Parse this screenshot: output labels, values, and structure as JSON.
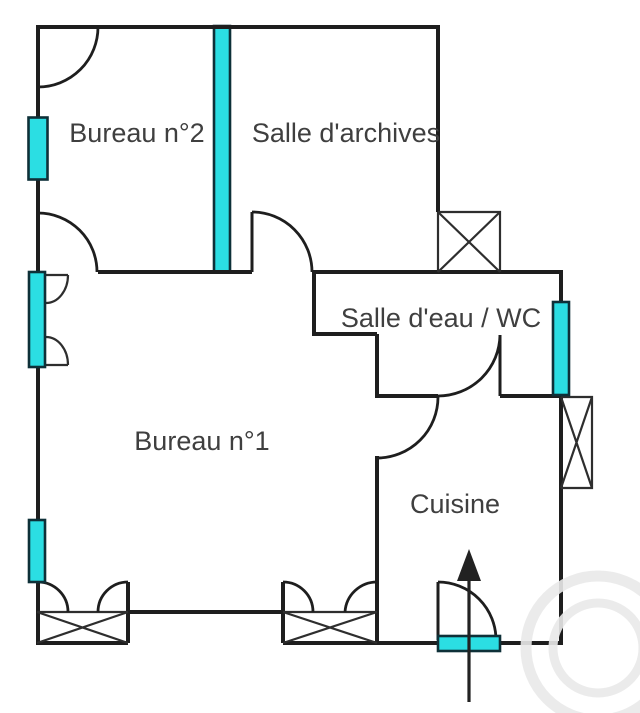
{
  "figure": {
    "type": "floor-plan"
  },
  "rooms": [
    {
      "id": "bureau-2",
      "label": "Bureau n°2"
    },
    {
      "id": "salle-archives",
      "label": "Salle d'archives"
    },
    {
      "id": "salle-eau-wc",
      "label": "Salle d'eau / WC"
    },
    {
      "id": "bureau-1",
      "label": "Bureau n°1"
    },
    {
      "id": "cuisine",
      "label": "Cuisine"
    }
  ],
  "icons": {
    "entry_arrow": "up-arrow-entrance",
    "door_swing": "quarter-circle-arc",
    "window": "cyan-glazing-bar",
    "glazed_partition": "cyan-vertical-bar",
    "crossed_box": "x-crossed-rectangle"
  },
  "colors": {
    "wall": "#1e1e1e",
    "thin": "#2e2e2e",
    "glazing": "#2bdee3",
    "glazing_border": "#0e3038",
    "label": "#3f3f3f",
    "watermark": "#e9e9e9",
    "background": "#ffffff"
  }
}
